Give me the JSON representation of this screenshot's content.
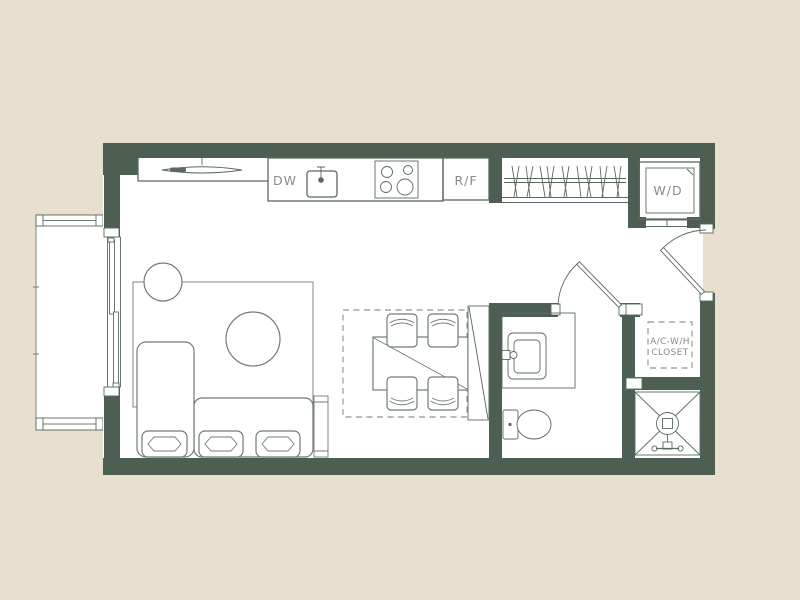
{
  "colors": {
    "background": "#e9dfce",
    "wall": "#4d5e52",
    "line": "#5a6a5e",
    "furniture": "#6f7d71",
    "label": "#848e85",
    "floor": "#ffffff"
  },
  "plan": {
    "type": "studio-apartment-floor-plan",
    "labels": {
      "dishwasher": "DW",
      "refrigerator_freezer": "R/F",
      "washer_dryer": "W/D",
      "utility_closet_line1": "A/C-W/H",
      "utility_closet_line2": "CLOSET"
    },
    "elements": [
      "balcony",
      "balcony-railings",
      "sliding-glass-door",
      "kitchen-counter",
      "range-hood-light",
      "dishwasher",
      "kitchen-sink",
      "cooktop-4-burner",
      "refrigerator",
      "wardrobe-closet-hanging-rod",
      "washer-dryer-closet",
      "entry-door",
      "bathroom-door",
      "living-rug",
      "round-side-table",
      "round-coffee-table",
      "sectional-sofa",
      "sofa-cushions",
      "console-table",
      "dining-dashed-zone",
      "dining-table",
      "dining-chairs",
      "tall-panel",
      "bathroom-vanity-sink",
      "toilet",
      "ac-water-heater-closet",
      "shower"
    ]
  }
}
